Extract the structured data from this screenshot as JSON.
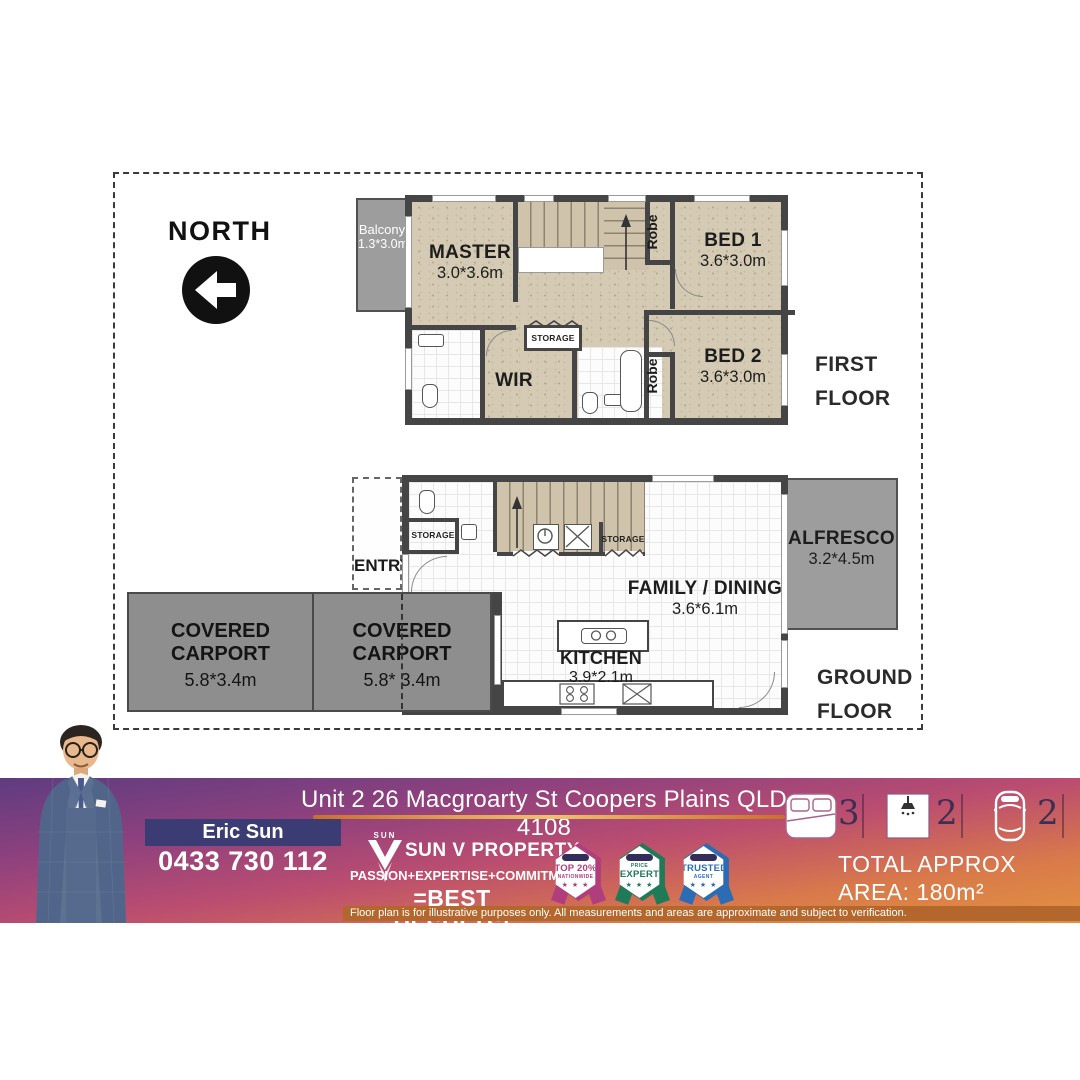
{
  "plan": {
    "north_label": "NORTH",
    "first_floor": {
      "title_line1": "FIRST",
      "title_line2": "FLOOR",
      "balcony_name": "Balcony",
      "balcony_dims": "1.3*3.0m",
      "master_name": "MASTER",
      "master_dims": "3.0*3.6m",
      "bed1_name": "BED 1",
      "bed1_dims": "3.6*3.0m",
      "bed2_name": "BED 2",
      "bed2_dims": "3.6*3.0m",
      "robe1": "Robe",
      "robe2": "Robe",
      "wir": "WIR",
      "storage": "STORAGE"
    },
    "ground_floor": {
      "title_line1": "GROUND",
      "title_line2": "FLOOR",
      "entry": "ENTRY",
      "storage1": "STORAGE",
      "storage2": "STORAGE",
      "family_name": "FAMILY / DINING",
      "family_dims": "3.6*6.1m",
      "kitchen_name": "KITCHEN",
      "kitchen_dims": "3.9*2.1m",
      "alfresco_name": "ALFRESCO",
      "alfresco_dims": "3.2*4.5m",
      "carport1_name": "COVERED CARPORT",
      "carport1_dims": "5.8*3.4m",
      "carport2_name": "COVERED CARPORT",
      "carport2_dims": "5.8* 3.4m"
    }
  },
  "banner": {
    "address": "Unit 2 26 Macgroarty St Coopers Plains QLD 4108",
    "agent_name": "Eric Sun",
    "agent_phone": "0433 730 112",
    "brand": {
      "logo_word": "SUN",
      "company": "SUN V PROPERTY",
      "tagline": "PASSION+EXPERTISE+COMMITMENT",
      "tagline2": "=BEST RESULTS!"
    },
    "badges": [
      {
        "line1": "TOP 20%",
        "line2": "NATIONWIDE",
        "stars": "★ ★ ★",
        "color": "#b03e7c"
      },
      {
        "line1": "PRICE",
        "line2": "EXPERT",
        "stars": "★ ★ ★",
        "color": "#1f7a58"
      },
      {
        "line1": "TRUSTED",
        "line2": "AGENT",
        "stars": "★ ★ ★",
        "color": "#2c6cb4"
      }
    ],
    "stats": {
      "beds": "3",
      "baths": "2",
      "cars": "2"
    },
    "area_line1": "TOTAL APPROX",
    "area_line2": "AREA: 180m²",
    "disclaimer": "Floor plan is for illustrative purposes only. All measurements and areas are approximate and subject to verification.",
    "colors": {
      "accent_indigo": "#3c3c74",
      "underline_gold": "#d9913c",
      "disclaimer_bg": "#b4672c",
      "wall": "#454545"
    }
  }
}
